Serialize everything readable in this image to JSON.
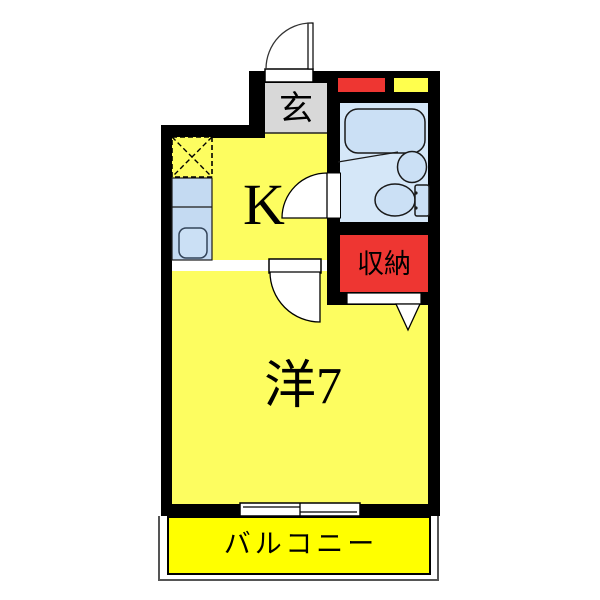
{
  "floorplan": {
    "labels": {
      "entrance": "玄",
      "kitchen": "K",
      "storage": "収納",
      "room": "洋7",
      "balcony": "バルコニー"
    },
    "colors": {
      "wall": "#000000",
      "room_yellow": "#FDFD60",
      "balcony_yellow": "#FFFF00",
      "entrance_gray": "#D8D8D8",
      "washroom_blue": "#D5E7F8",
      "fixture_blue": "#CBE0F5",
      "counter_blue": "#C4DAF2",
      "storage_red": "#EE3632",
      "inset_red": "#EE3632",
      "inset_yellow": "#FFFF4D",
      "door_white": "#FFFFFF"
    }
  }
}
